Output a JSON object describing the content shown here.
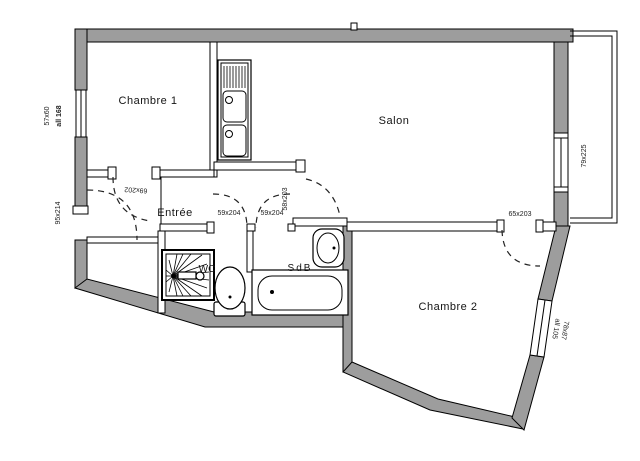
{
  "plan": {
    "rooms": [
      {
        "label": "Chambre 1"
      },
      {
        "label": "Salon"
      },
      {
        "label": "Entrée"
      },
      {
        "label": "WC"
      },
      {
        "label": "SdB"
      },
      {
        "label": "Chambre 2"
      }
    ],
    "dims": {
      "left_window_size": "57x60",
      "left_window_sill": "all 168",
      "entry_door": "95x214",
      "chambre1_door": "69x202",
      "wc_door": "59x204",
      "sdb_door": "59x204",
      "salon_door": "58x203",
      "chambre2_door": "65x203",
      "balcony": "79x225",
      "chambre2_window_size": "78x87",
      "chambre2_window_sill": "all 105"
    },
    "colors": {
      "wall": "#9d9d9d",
      "line": "#000000",
      "text": "#141414",
      "bg": "#ffffff"
    }
  }
}
